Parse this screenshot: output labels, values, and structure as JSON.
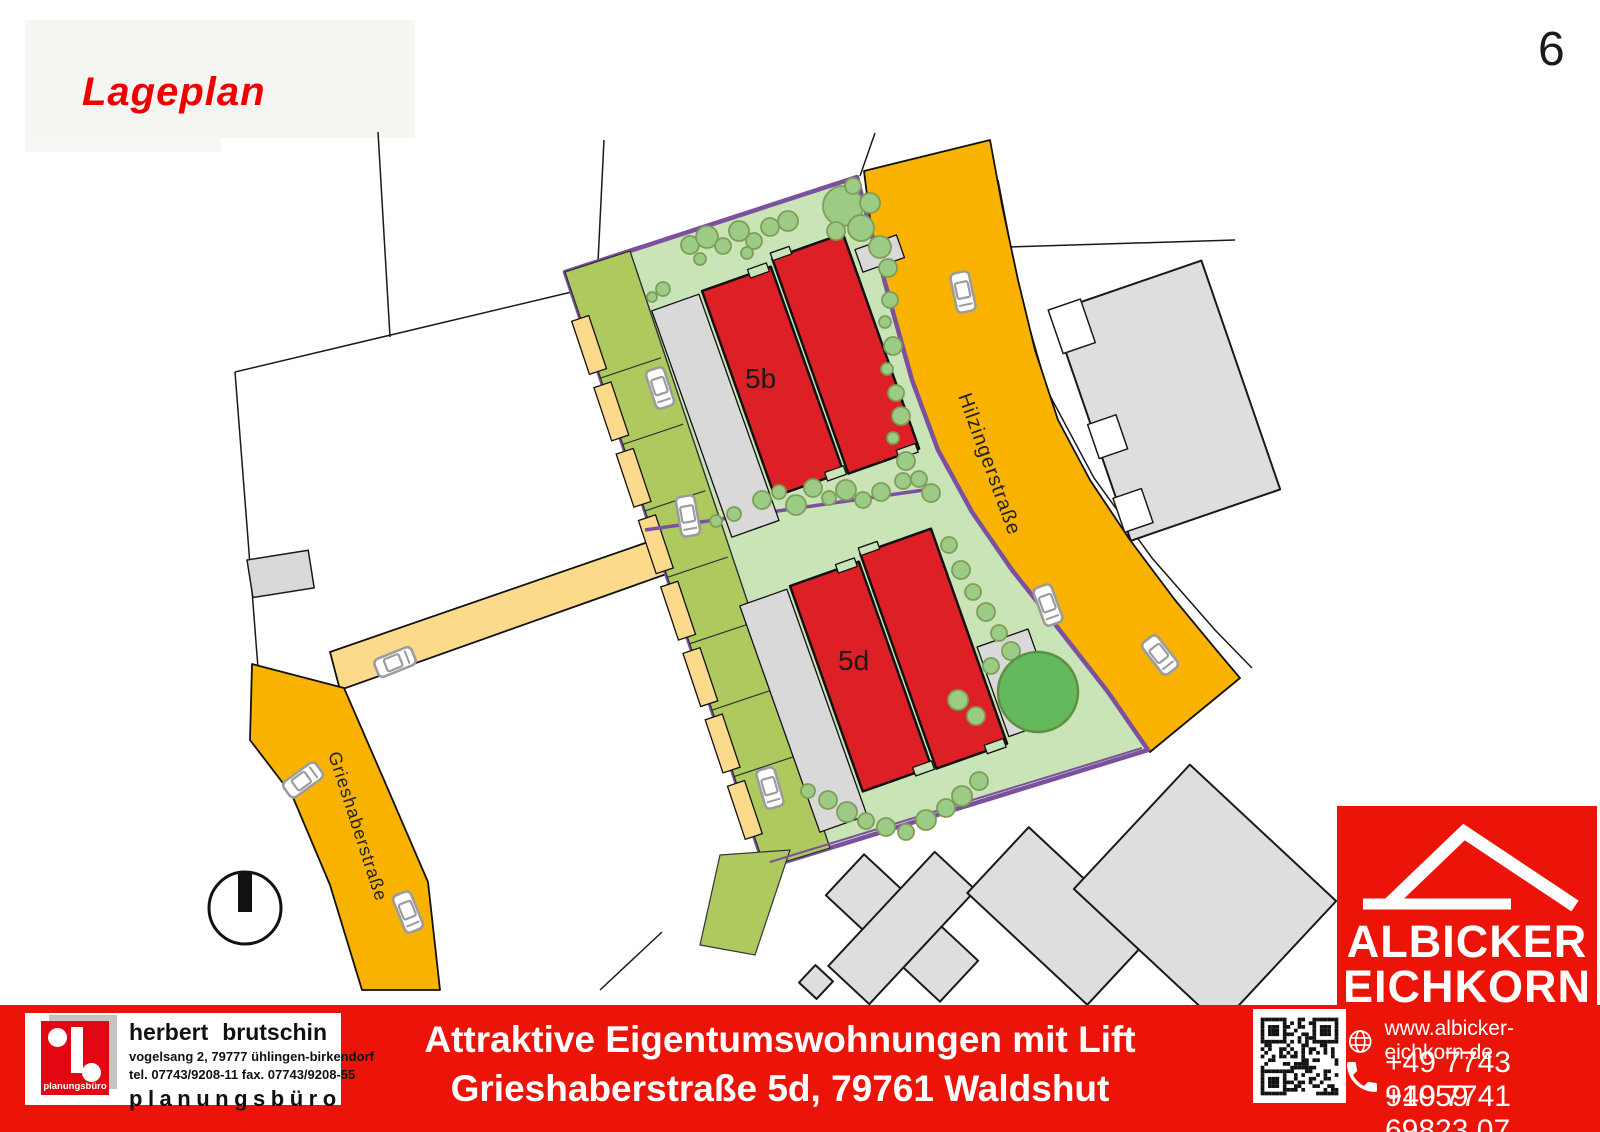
{
  "page": {
    "title": "Lageplan",
    "page_number": "6"
  },
  "map": {
    "labels": {
      "building_top": "5b",
      "building_bottom": "5d",
      "street_right": "Hilzingerstraße",
      "street_left": "Grieshaberstraße"
    },
    "icons": {
      "north_arrow": "circle with solid bar pointing north",
      "car": "parked car symbol",
      "tree": "tree canopy circle"
    },
    "colors": {
      "street_orange": "#f9b200",
      "street_pale": "#fbda8b",
      "site_green": "#c9e4b6",
      "green_strip_olive": "#aeca5e",
      "building_red": "#dd1f26",
      "boundary_purple": "#7b50a0",
      "parking_gray": "#d9d9d9",
      "neighbor_gray": "#dedede"
    }
  },
  "footer": {
    "banner_line1": "Attraktive Eigentumswohnungen mit Lift",
    "banner_line2": "Grieshaberstraße 5d, 79761 Waldshut",
    "banner_color": "#ec1408",
    "brutschin": {
      "name_first": "herbert",
      "name_last": "brutschin",
      "address": "vogelsang 2, 79777 ühlingen-birkendorf",
      "tel_fax": "tel. 07743/9208-11  fax. 07743/9208-55",
      "word": "planungsbüro",
      "logo_caption": "planungsbüro",
      "logo_red": "#e30613"
    },
    "contact": {
      "website": "www.albicker-eichkorn.de",
      "phone1": "+49 7743 91059",
      "phone2": "+49 7741 69823 07",
      "icons": {
        "globe": "globe-icon",
        "phone": "phone-icon",
        "qr": "qr-code"
      }
    }
  },
  "brand": {
    "line1": "ALBICKER",
    "line2": "EICHKORN",
    "line3": "Immobilien+Wohnbau",
    "icon": "roof-icon"
  }
}
